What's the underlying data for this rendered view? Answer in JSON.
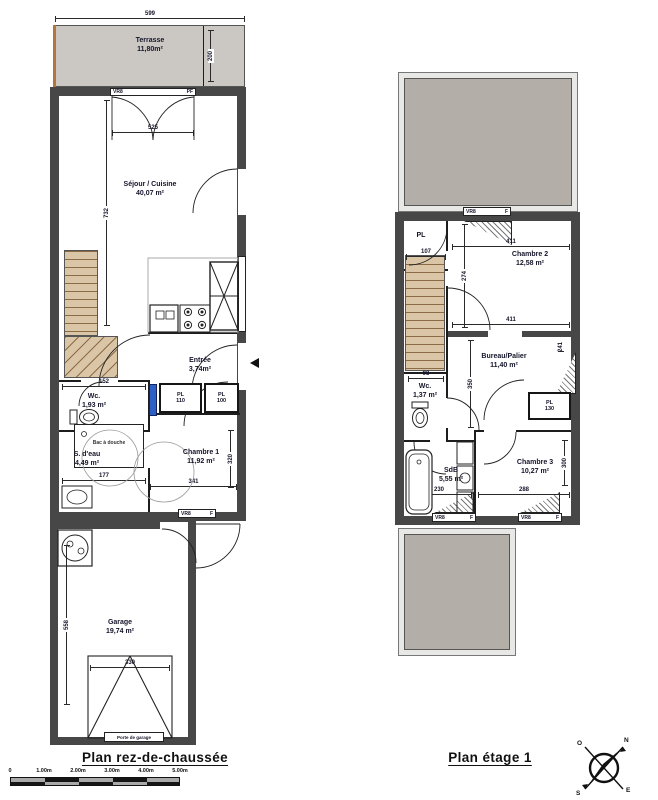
{
  "gf": {
    "caption": "Plan rez-de-chaussée",
    "terrace": {
      "name": "Terrasse",
      "area": "11,80m²"
    },
    "sejour": {
      "name": "Séjour / Cuisine",
      "area": "40,07 m²"
    },
    "entree": {
      "name": "Entrée",
      "area": "3,74m²"
    },
    "wc": {
      "name": "Wc.",
      "area": "1,93 m²"
    },
    "pl110": {
      "name": "PL",
      "size": "110"
    },
    "pl100": {
      "name": "PL",
      "size": "100"
    },
    "sdeau": {
      "name": "S. d'eau",
      "area": "4,49 m²"
    },
    "shower_label": "Bac à douche",
    "chambre1": {
      "name": "Chambre 1",
      "area": "11,92 m²"
    },
    "garage": {
      "name": "Garage",
      "area": "19,74 m²"
    },
    "porte_garage": "Porte de garage",
    "dims": {
      "terrace_w": "599",
      "terrace_h": "200",
      "door_w": "525",
      "sejour_h": "732",
      "wc_w": "152",
      "sdeau_w": "177",
      "ch1_w": "341",
      "ch1_h": "320",
      "garage_door_w": "330",
      "garage_h": "558"
    }
  },
  "ff": {
    "caption": "Plan étage 1",
    "pl": {
      "name": "PL"
    },
    "chambre2": {
      "name": "Chambre 2",
      "area": "12,58 m²"
    },
    "bureau": {
      "name": "Bureau/Palier",
      "area": "11,40 m²"
    },
    "wc": {
      "name": "Wc.",
      "area": "1,37 m²"
    },
    "pl130": {
      "name": "PL",
      "size": "130"
    },
    "sdb": {
      "name": "SdB",
      "area": "5,55 m²"
    },
    "chambre3": {
      "name": "Chambre 3",
      "area": "10,27 m²"
    },
    "dims": {
      "pl_w": "107",
      "ch2_w_top": "411",
      "ch2_h": "274",
      "ch2_w_bot": "411",
      "bureau_h": "350",
      "wc_w": "98",
      "sdb_w": "230",
      "ch3_w": "288",
      "ch3_h": "300",
      "win_h": "241"
    }
  },
  "win": {
    "vr8": "VR8",
    "pf": "PF",
    "f": "F"
  },
  "scalebar": {
    "ticks": [
      "0",
      "1.00m",
      "2.00m",
      "3.00m",
      "4.00m",
      "5.00m"
    ]
  },
  "compass": {
    "west": "O",
    "north": "N",
    "east": "E",
    "south": "S"
  },
  "colors": {
    "wall": "#474747",
    "terrace": "#cbc8c3",
    "roof": "#b3aea7",
    "roof_frame": "#e8e8e6",
    "stairs": "#dac5a7",
    "stair_line": "#8a6b45",
    "accent_blue": "#2e5fc5",
    "ink": "#14142a"
  }
}
